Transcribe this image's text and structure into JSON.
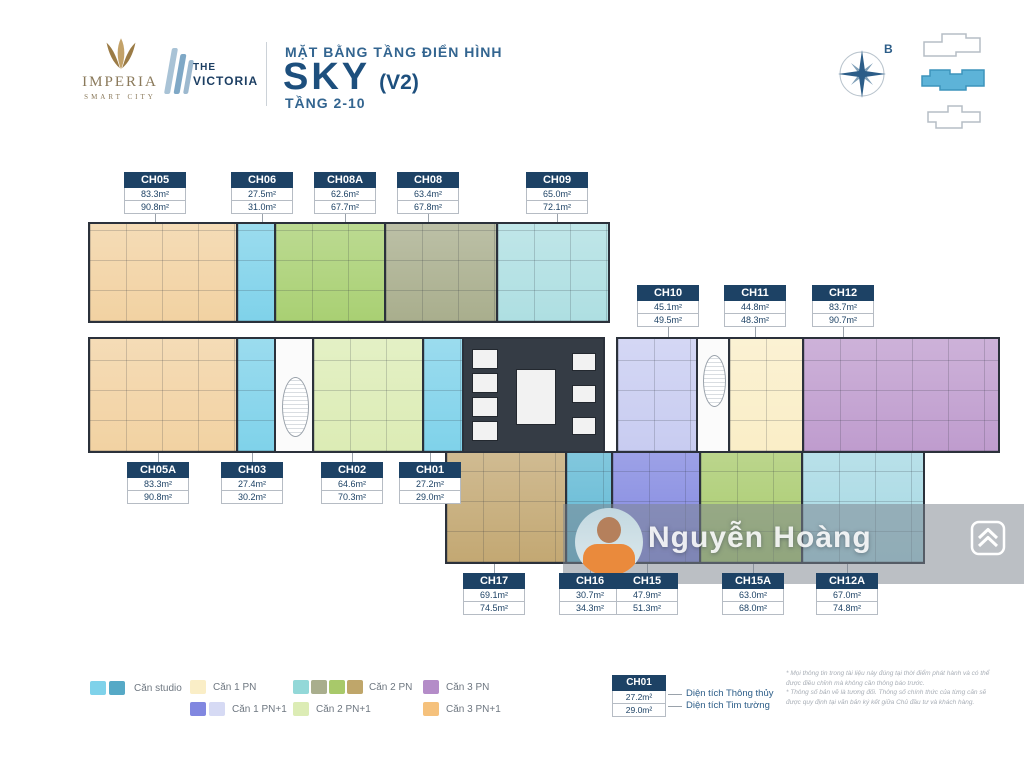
{
  "brand": {
    "imperia": "IMPERIA",
    "imperia_sub": "SMART CITY",
    "victoria_top": "THE",
    "victoria_bottom": "VICTORIA"
  },
  "title": {
    "small": "MẶT BẰNG TẦNG ĐIỂN HÌNH",
    "main": "SKY",
    "variant": "(V2)",
    "floors": "TẦNG 2-10"
  },
  "compass": {
    "label": "B"
  },
  "watermark": {
    "name": "Nguyễn Hoàng"
  },
  "units": [
    {
      "key": "ch05",
      "id": "CH05",
      "tt": "83.3m²",
      "tm": "90.8m²"
    },
    {
      "key": "ch06",
      "id": "CH06",
      "tt": "27.5m²",
      "tm": "31.0m²"
    },
    {
      "key": "ch08a",
      "id": "CH08A",
      "tt": "62.6m²",
      "tm": "67.7m²"
    },
    {
      "key": "ch08",
      "id": "CH08",
      "tt": "63.4m²",
      "tm": "67.8m²"
    },
    {
      "key": "ch09",
      "id": "CH09",
      "tt": "65.0m²",
      "tm": "72.1m²"
    },
    {
      "key": "ch10",
      "id": "CH10",
      "tt": "45.1m²",
      "tm": "49.5m²"
    },
    {
      "key": "ch11",
      "id": "CH11",
      "tt": "44.8m²",
      "tm": "48.3m²"
    },
    {
      "key": "ch12",
      "id": "CH12",
      "tt": "83.7m²",
      "tm": "90.7m²"
    },
    {
      "key": "ch05a",
      "id": "CH05A",
      "tt": "83.3m²",
      "tm": "90.8m²"
    },
    {
      "key": "ch03",
      "id": "CH03",
      "tt": "27.4m²",
      "tm": "30.2m²"
    },
    {
      "key": "ch02",
      "id": "CH02",
      "tt": "64.6m²",
      "tm": "70.3m²"
    },
    {
      "key": "ch01",
      "id": "CH01",
      "tt": "27.2m²",
      "tm": "29.0m²"
    },
    {
      "key": "ch17",
      "id": "CH17",
      "tt": "69.1m²",
      "tm": "74.5m²"
    },
    {
      "key": "ch16",
      "id": "CH16",
      "tt": "30.7m²",
      "tm": "34.3m²"
    },
    {
      "key": "ch15",
      "id": "CH15",
      "tt": "47.9m²",
      "tm": "51.3m²"
    },
    {
      "key": "ch15a",
      "id": "CH15A",
      "tt": "63.0m²",
      "tm": "68.0m²"
    },
    {
      "key": "ch12a",
      "id": "CH12A",
      "tt": "67.0m²",
      "tm": "74.8m²"
    }
  ],
  "fills": {
    "ch05": "#f2d2a2",
    "ch06": "#7fd2ea",
    "ch08a": "#a9d073",
    "ch08": "#a9ae8d",
    "ch09": "#aedfe2",
    "ch10": "#c8ccf1",
    "ch11": "#faeec7",
    "ch12": "#bf9cce",
    "ch05a": "#f2d2a2",
    "ch03": "#7fd2ea",
    "ch02": "#dcecb5",
    "ch01": "#7fd2ea",
    "ch17": "#c3a873",
    "ch16": "#5fb8d4",
    "ch15": "#8187e0",
    "ch15a": "#a8ca6c",
    "ch12a": "#a5d8e3"
  },
  "legend": {
    "studio": {
      "label": "Căn studio",
      "colors": [
        "#7fd2ea",
        "#56a9c6"
      ]
    },
    "pn1": {
      "label": "Căn 1 PN",
      "colors": [
        "#faeec7"
      ]
    },
    "pn1p": {
      "label": "Căn 1 PN+1",
      "colors": [
        "#8187e0",
        "#d6daf4"
      ]
    },
    "pn2": {
      "label": "Căn 2 PN",
      "colors": [
        "#93d8d8",
        "#a9ae8d",
        "#a8c96a",
        "#bfa66a"
      ]
    },
    "pn2p": {
      "label": "Căn 2 PN+1",
      "colors": [
        "#dcecb5"
      ]
    },
    "pn3": {
      "label": "Căn 3 PN",
      "colors": [
        "#b48cc8"
      ]
    },
    "pn3p": {
      "label": "Căn 3 PN+1",
      "colors": [
        "#f5c17c"
      ]
    }
  },
  "key_box": {
    "id": "CH01",
    "tt": "27.2m²",
    "tm": "29.0m²",
    "tt_label": "Diện tích Thông thủy",
    "tm_label": "Diện tích Tim tường"
  },
  "disclaimer": {
    "line1": "* Mọi thông tin trong tài liệu này đúng tại thời điểm phát hành và có thể",
    "line2": "được điều chỉnh mà không cần thông báo trước.",
    "line3": "* Thông số bản vẽ là tương đối. Thông số chính thức của từng căn sẽ",
    "line4": "được quy định tại văn bản ký kết giữa Chủ đầu tư và khách hàng."
  }
}
